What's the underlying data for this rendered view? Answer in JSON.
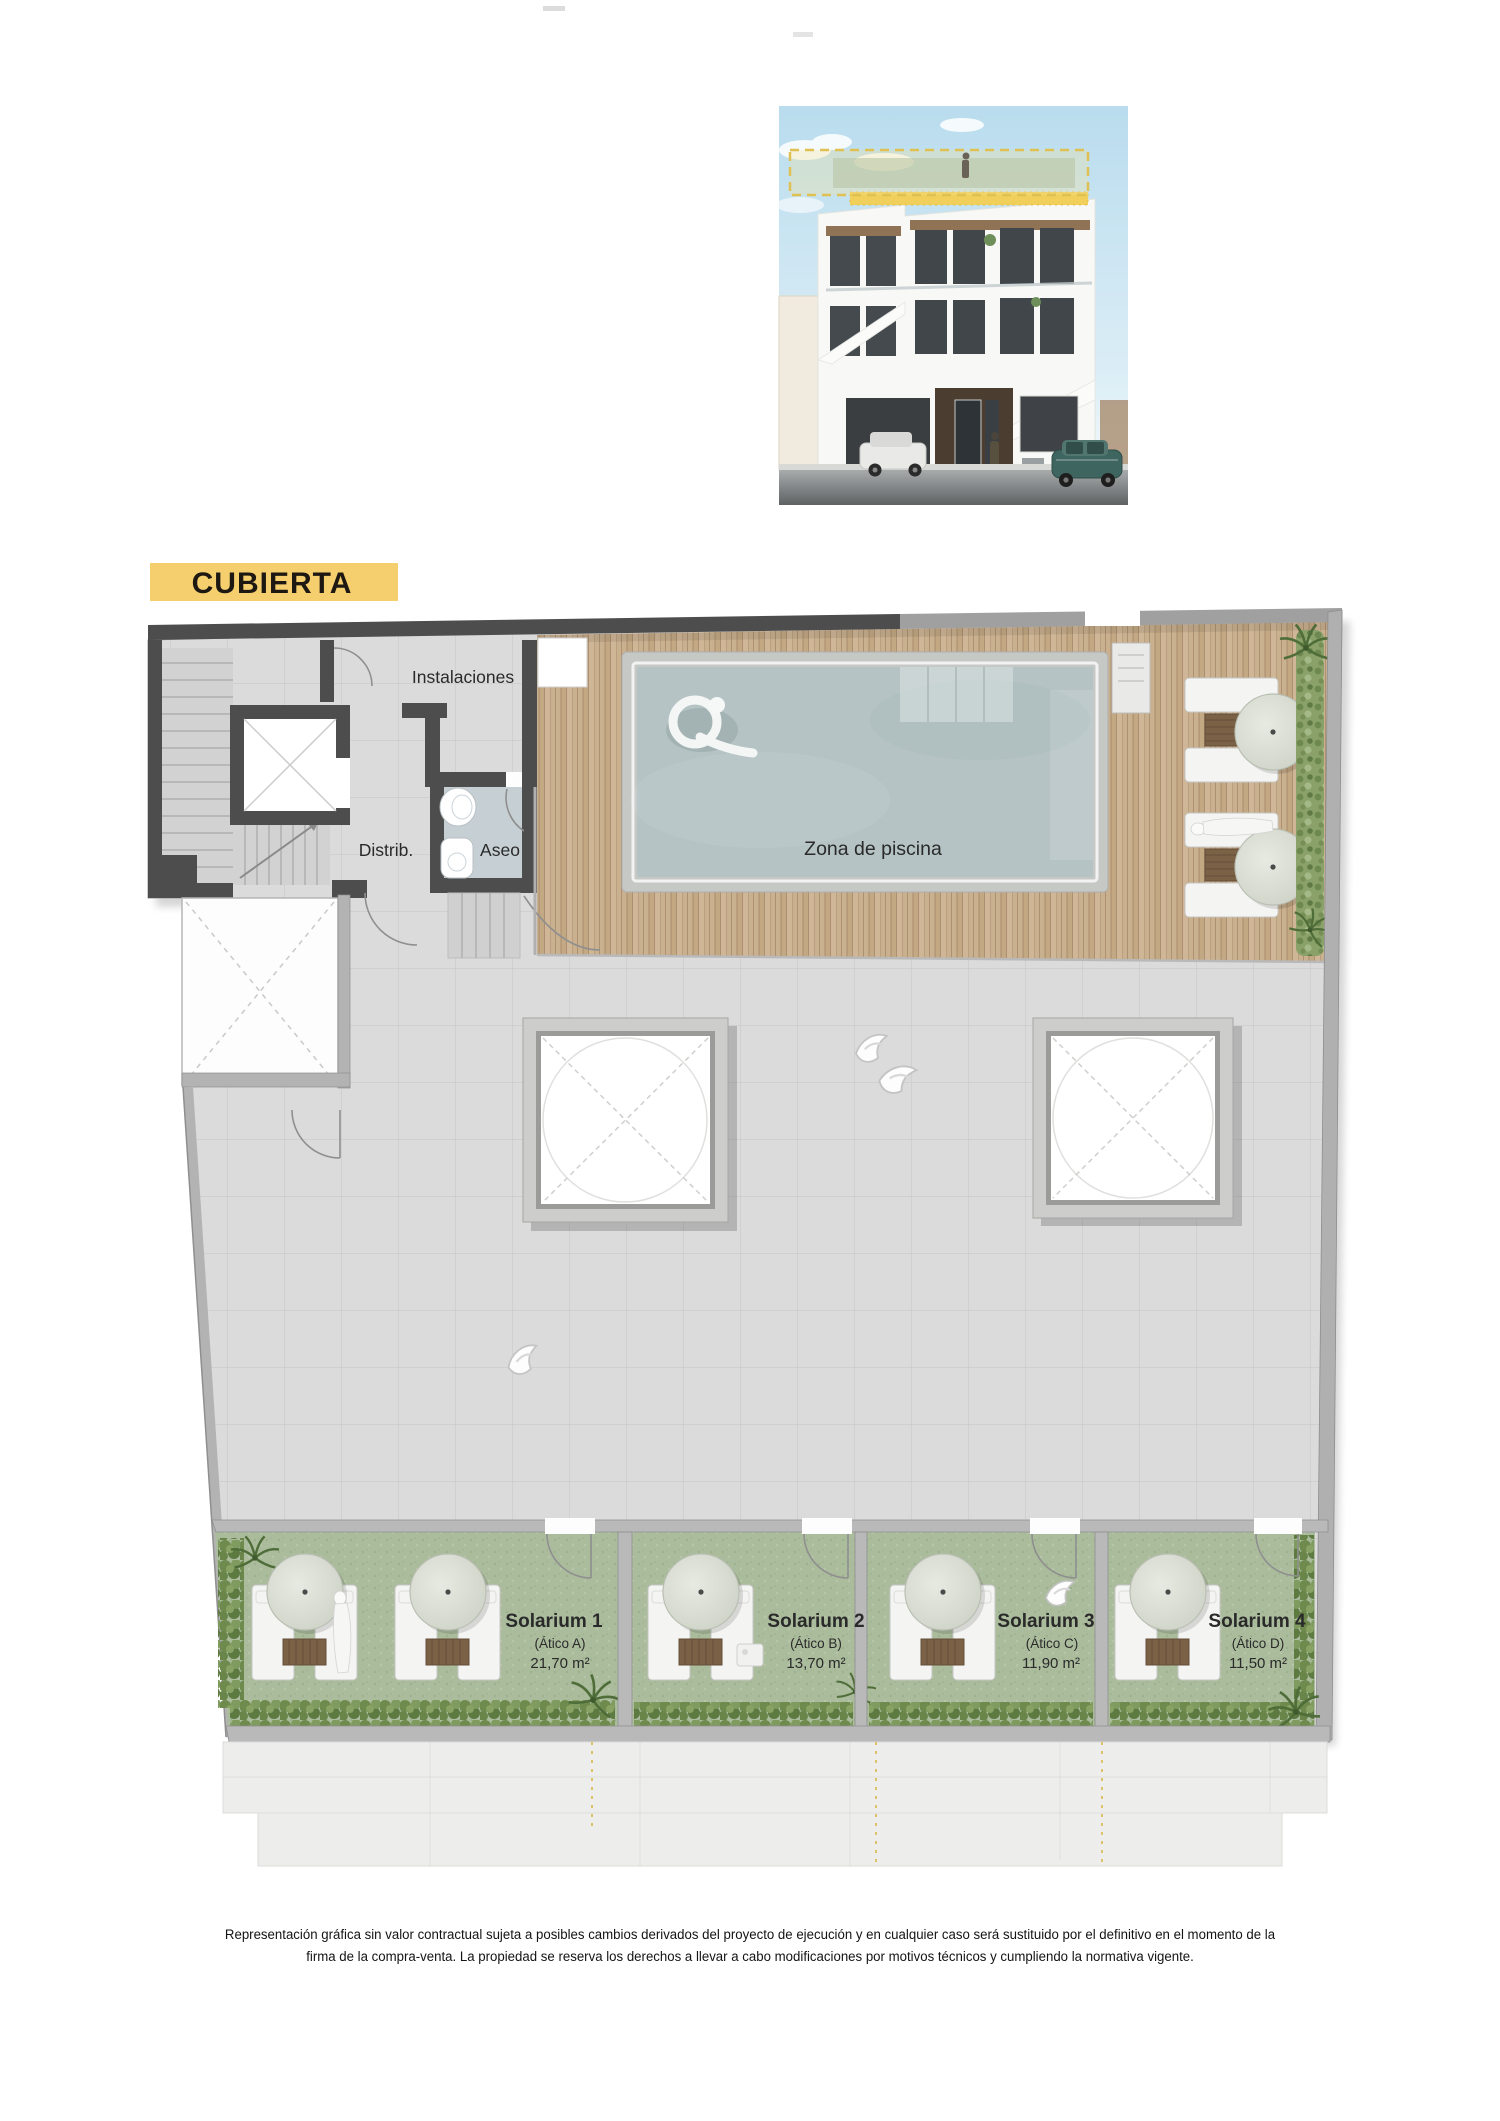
{
  "title": {
    "label": "CUBIERTA"
  },
  "colors": {
    "badge_bg": "#f5cf6d",
    "wall_dark": "#4d4d4d",
    "wall_light": "#b3b3b3",
    "terrace": "#dadbda",
    "deck_wood": "#c9b08f",
    "pool_water": "#b5c3c4",
    "solarium_grass": "#abbc9d",
    "render_highlight": "#dfc052"
  },
  "plan": {
    "labels": {
      "instalaciones": "Instalaciones",
      "distrib": "Distrib.",
      "aseo": "Aseo",
      "pool_zone": "Zona de piscina"
    },
    "solariums": [
      {
        "name": "Solarium 1",
        "unit": "(Ático A)",
        "area": "21,70 m²"
      },
      {
        "name": "Solarium 2",
        "unit": "(Ático B)",
        "area": "13,70 m²"
      },
      {
        "name": "Solarium 3",
        "unit": "(Ático C)",
        "area": "11,90 m²"
      },
      {
        "name": "Solarium 4",
        "unit": "(Ático D)",
        "area": "11,50 m²"
      }
    ]
  },
  "footer": {
    "line1": "Representación gráfica sin valor contractual sujeta a posibles cambios derivados del proyecto de ejecución y en cualquier caso será sustituido por el definitivo en el momento de la",
    "line2": "firma de la compra-venta. La propiedad se reserva los derechos a llevar a cabo modificaciones por motivos técnicos y cumpliendo la normativa vigente."
  }
}
